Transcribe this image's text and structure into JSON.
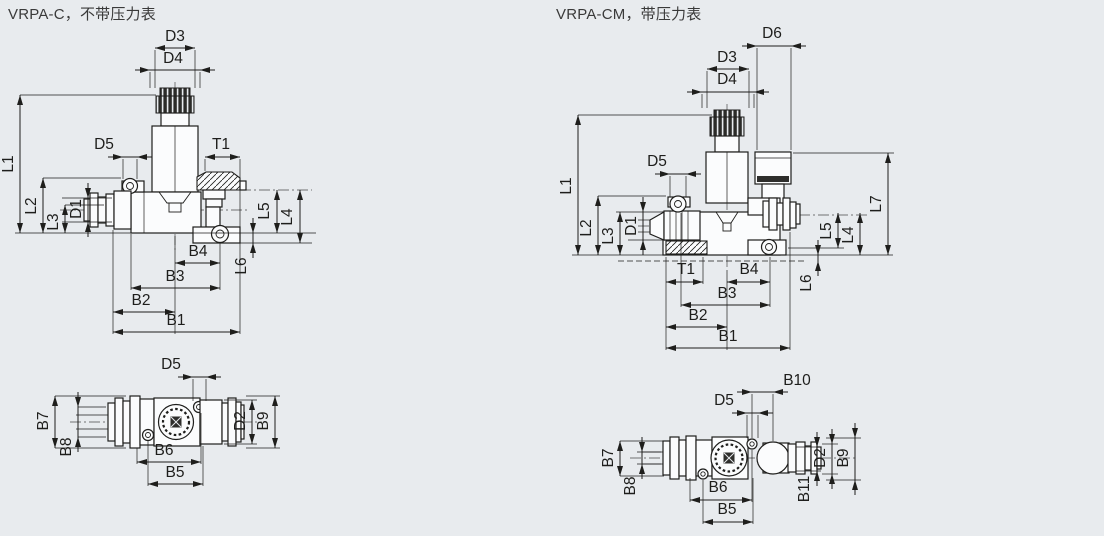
{
  "colors": {
    "background": "#e8ebee",
    "line": "#1e1e1c",
    "part_fill": "#fbfcfd",
    "header_text": "#3a3a3a"
  },
  "panels": [
    {
      "title": "VRPA-C，不带压力表",
      "views": {
        "front": {
          "dims": {
            "d3": "D3",
            "d4": "D4",
            "l1": "L1",
            "l2": "L2",
            "l3": "L3",
            "d1": "D1",
            "d5": "D5",
            "t1": "T1",
            "l5": "L5",
            "l4": "L4",
            "l6": "L6",
            "b4": "B4",
            "b3": "B3",
            "b2": "B2",
            "b1": "B1"
          }
        },
        "bottom": {
          "dims": {
            "d5": "D5",
            "b7": "B7",
            "b8": "B8",
            "d2": "D2",
            "b9": "B9",
            "b6": "B6",
            "b5": "B5"
          }
        }
      }
    },
    {
      "title": "VRPA-CM，带压力表",
      "views": {
        "front": {
          "dims": {
            "d6": "D6",
            "d3": "D3",
            "d4": "D4",
            "l1": "L1",
            "l2": "L2",
            "l3": "L3",
            "d1": "D1",
            "d5": "D5",
            "t1": "T1",
            "b4": "B4",
            "b3": "B3",
            "b2": "B2",
            "b1": "B1",
            "l5": "L5",
            "l4": "L4",
            "l7": "L7",
            "l6": "L6"
          }
        },
        "bottom": {
          "dims": {
            "b10": "B10",
            "d5": "D5",
            "b7": "B7",
            "b8": "B8",
            "d2": "D2",
            "b9": "B9",
            "b11": "B11",
            "b6": "B6",
            "b5": "B5"
          }
        }
      }
    }
  ]
}
